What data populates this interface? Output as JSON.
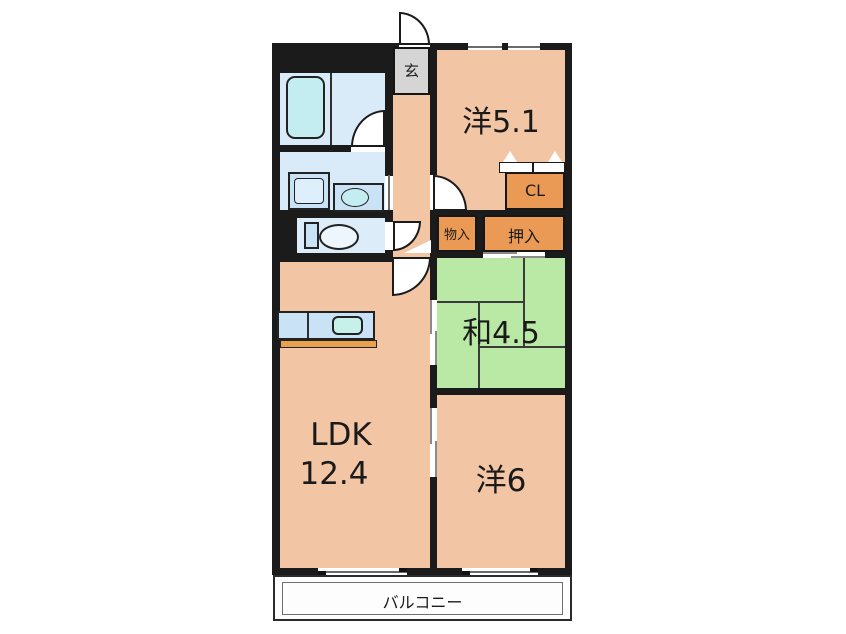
{
  "title": "apartment-floor-plan",
  "colors": {
    "wall": "#1b1b1b",
    "room_salmon": "#f2c5a4",
    "tatami_green": "#b9e9a4",
    "closet_orange": "#eb9a55",
    "wet_room_blue": "#d9ebf8",
    "fixture_blue": "#c9e2f6",
    "basin_cyan": "#c3edf1",
    "genkan_gray": "#d5d5d5",
    "counter_base_orange": "#e9a14e"
  },
  "rooms": {
    "genkan": {
      "label": "玄"
    },
    "western_51": {
      "label": "洋5.1"
    },
    "closet_cl": {
      "label": "CL"
    },
    "storage": {
      "label": "物入"
    },
    "oshiire": {
      "label": "押入"
    },
    "japanese_45": {
      "label": "和4.5"
    },
    "ldk": {
      "label": "LDK",
      "size": "12.4"
    },
    "western_6": {
      "label": "洋6"
    },
    "balcony": {
      "label": "バルコニー"
    }
  },
  "fixtures": [
    "bathtub",
    "washing-machine-pan",
    "vanity-basin",
    "toilet",
    "kitchen-counter",
    "kitchen-sink",
    "entrance-door",
    "folding-closet-door"
  ]
}
